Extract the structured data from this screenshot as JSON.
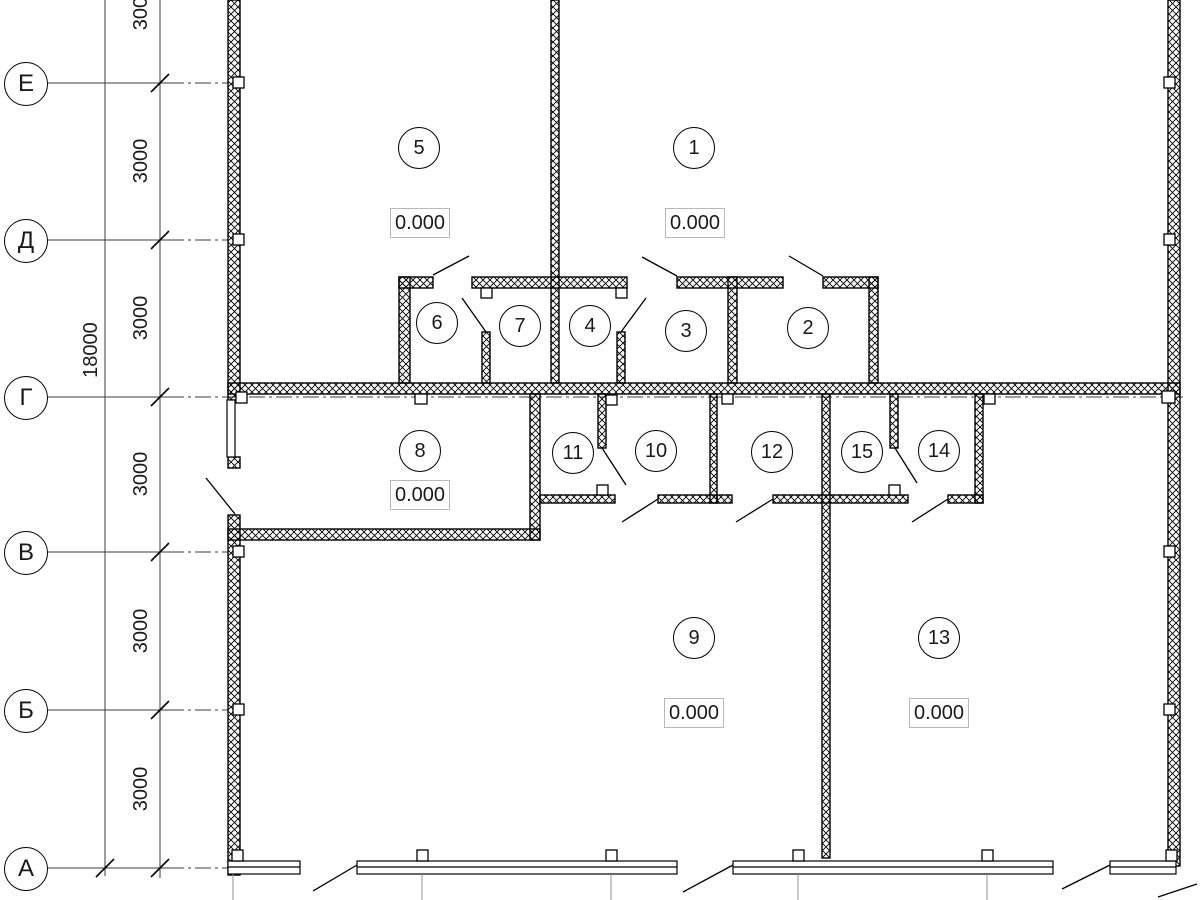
{
  "drawing_type": "architectural floor plan",
  "colors": {
    "background": "#ffffff",
    "line": "#000000",
    "axis_line": "#3c3c3c",
    "extension_line": "#909090",
    "elevation_box_border": "#b8b8b8"
  },
  "grid": {
    "axes": [
      {
        "label": "Е"
      },
      {
        "label": "Д"
      },
      {
        "label": "Г"
      },
      {
        "label": "В"
      },
      {
        "label": "Б"
      },
      {
        "label": "А"
      }
    ],
    "spacing_label": "3000",
    "total_label": "18000"
  },
  "rooms": [
    {
      "number": "5"
    },
    {
      "number": "1"
    },
    {
      "number": "6"
    },
    {
      "number": "7"
    },
    {
      "number": "4"
    },
    {
      "number": "3"
    },
    {
      "number": "2"
    },
    {
      "number": "8"
    },
    {
      "number": "11"
    },
    {
      "number": "10"
    },
    {
      "number": "12"
    },
    {
      "number": "15"
    },
    {
      "number": "14"
    },
    {
      "number": "9"
    },
    {
      "number": "13"
    }
  ],
  "elevation_label": "0.000"
}
